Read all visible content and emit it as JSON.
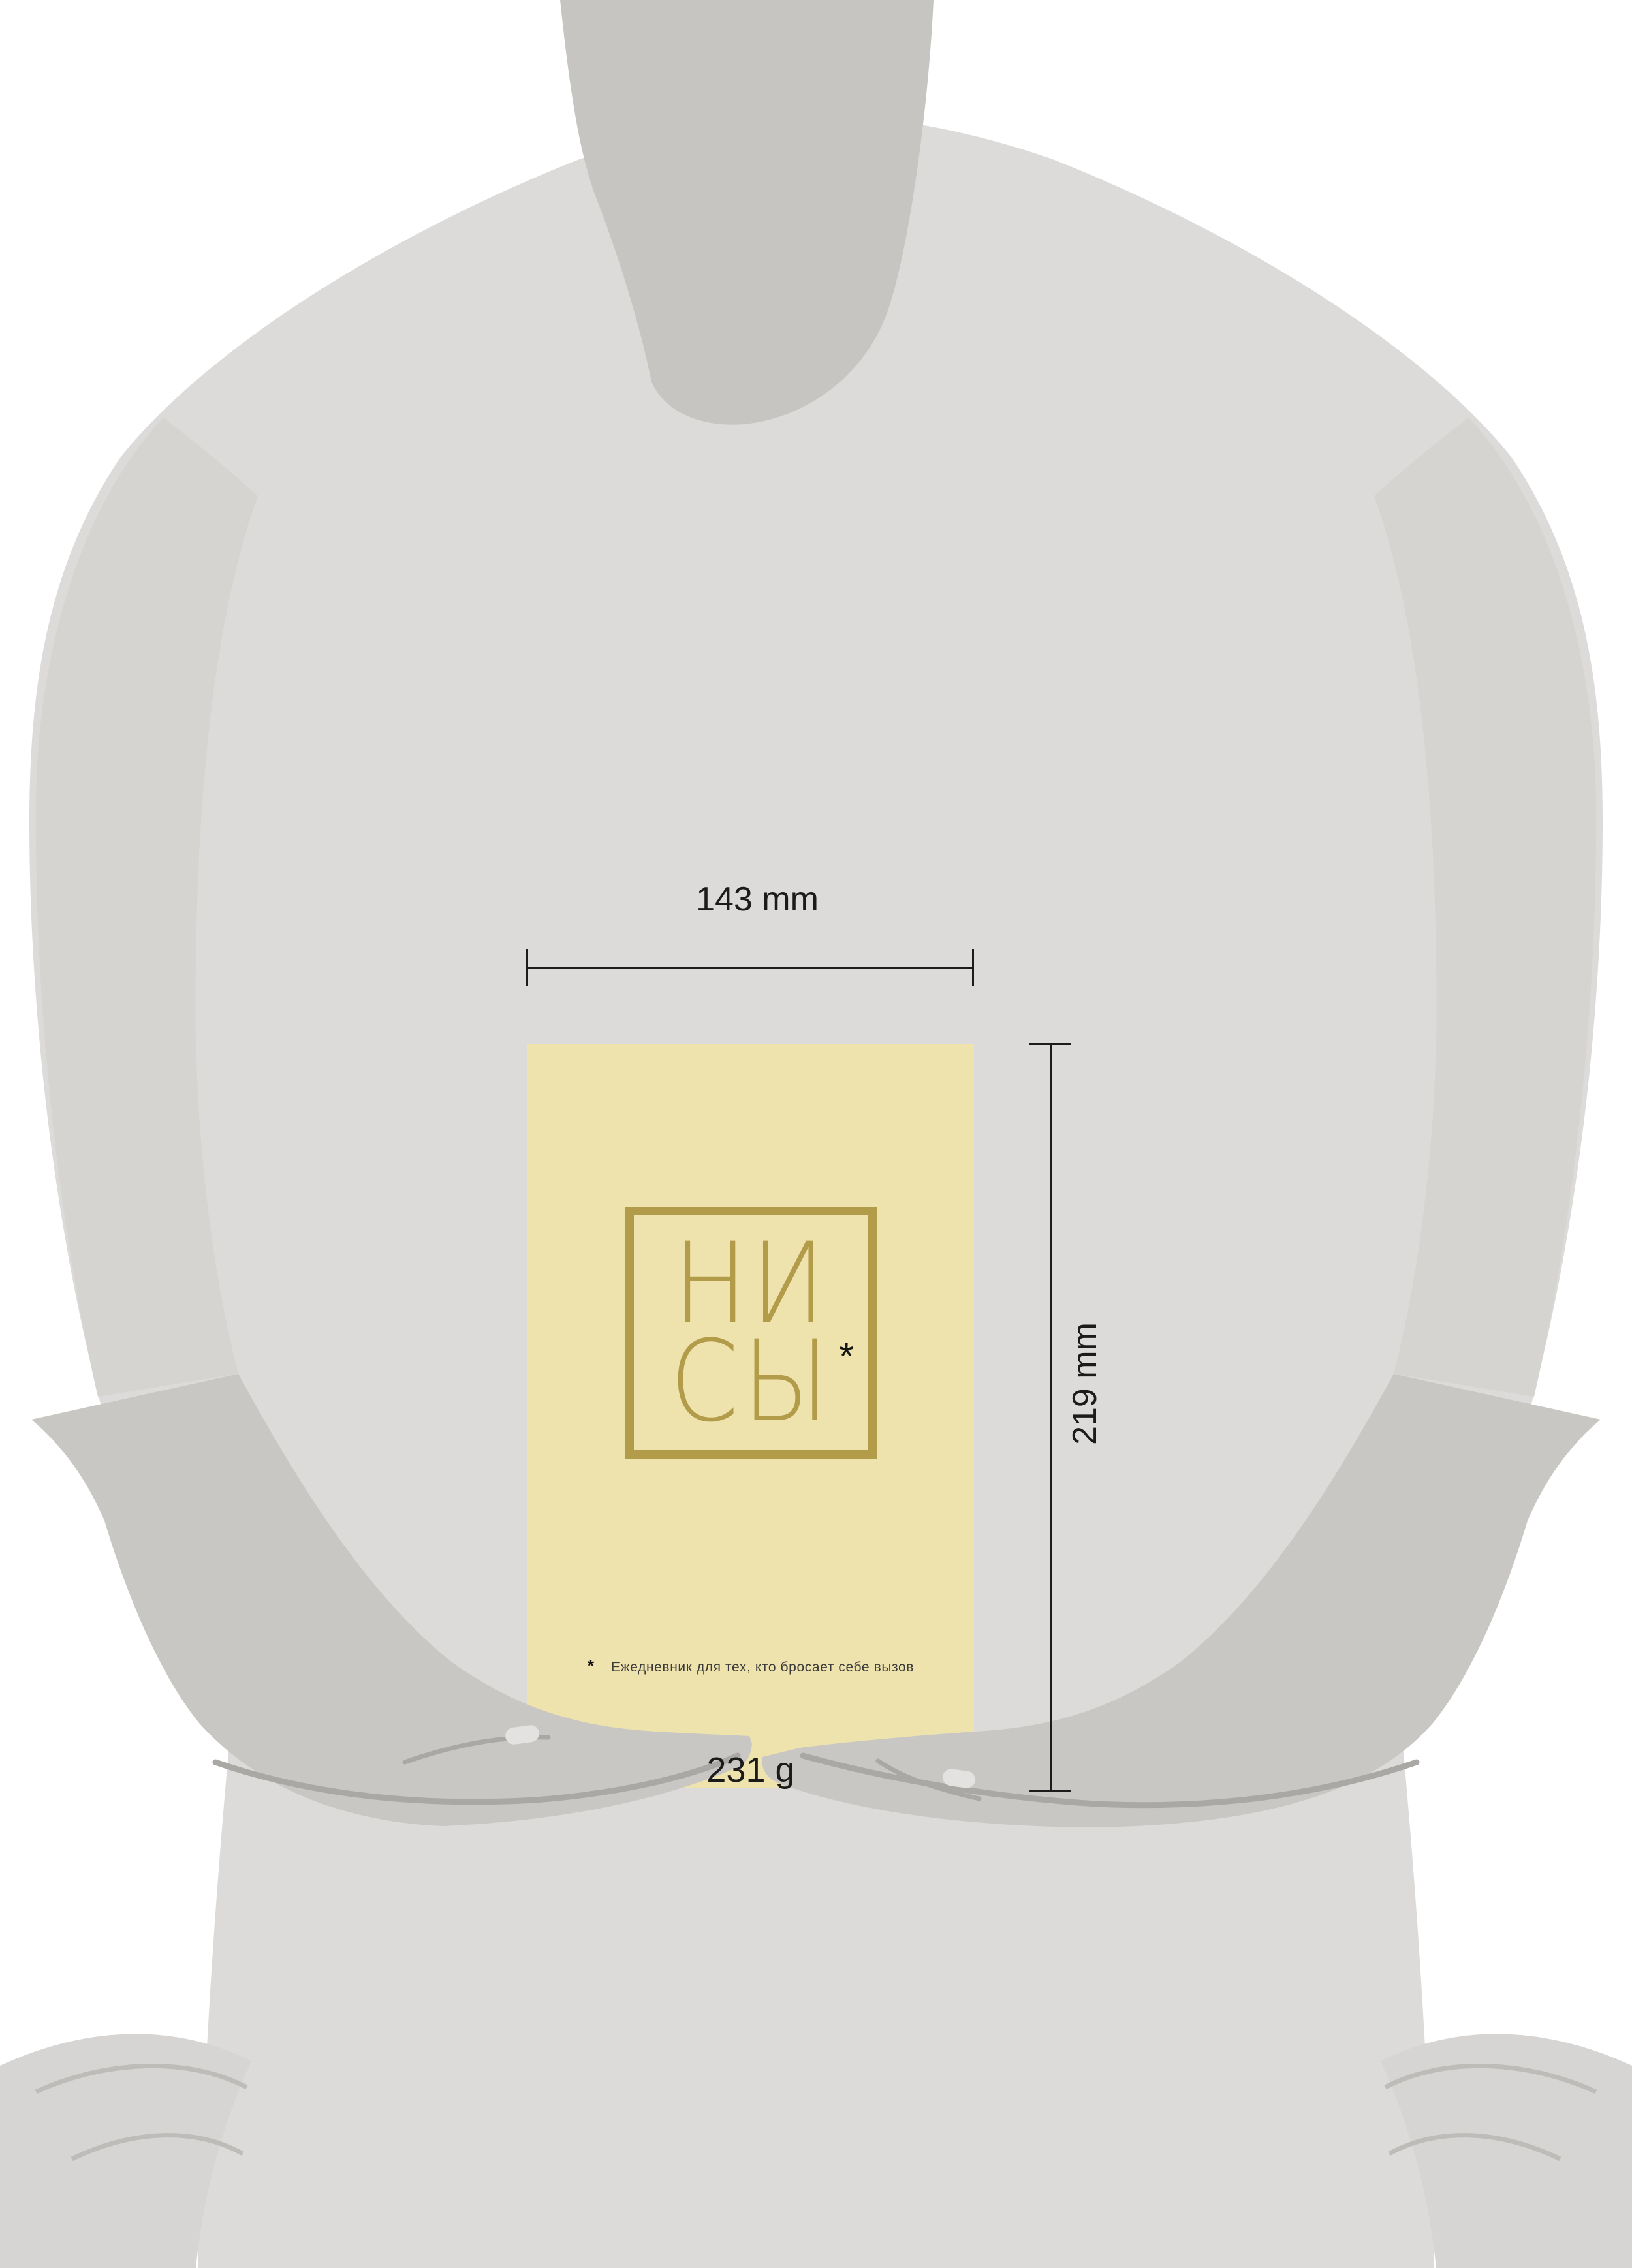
{
  "dimensions": {
    "width_label": "143 mm",
    "height_label": "219 mm",
    "weight_label": "231 g"
  },
  "book": {
    "logo_line1": "НИ",
    "logo_line2": "СЫ",
    "logo_asterisk": "*",
    "footnote_marker": "*",
    "footnote_text": "Ежедневник для тех, кто бросает себе вызов"
  },
  "colors": {
    "background": "#ffffff",
    "body": "#dcdbd9",
    "neck_shadow": "#c6c5c1",
    "sleeve": "#d5d4d1",
    "forearm_hand": "#c8c7c3",
    "hand_contour": "#a9a8a5",
    "nail": "#e3e2e0",
    "hem_corner": "#d6d5d3",
    "hem_line": "#bdbcb9",
    "book_cover": "#efe3ad",
    "logo_gold": "#b29b49",
    "asterisk_ink": "#141414",
    "dimension_ink": "#1c1c1c",
    "footnote_ink": "#3b3b3b"
  }
}
